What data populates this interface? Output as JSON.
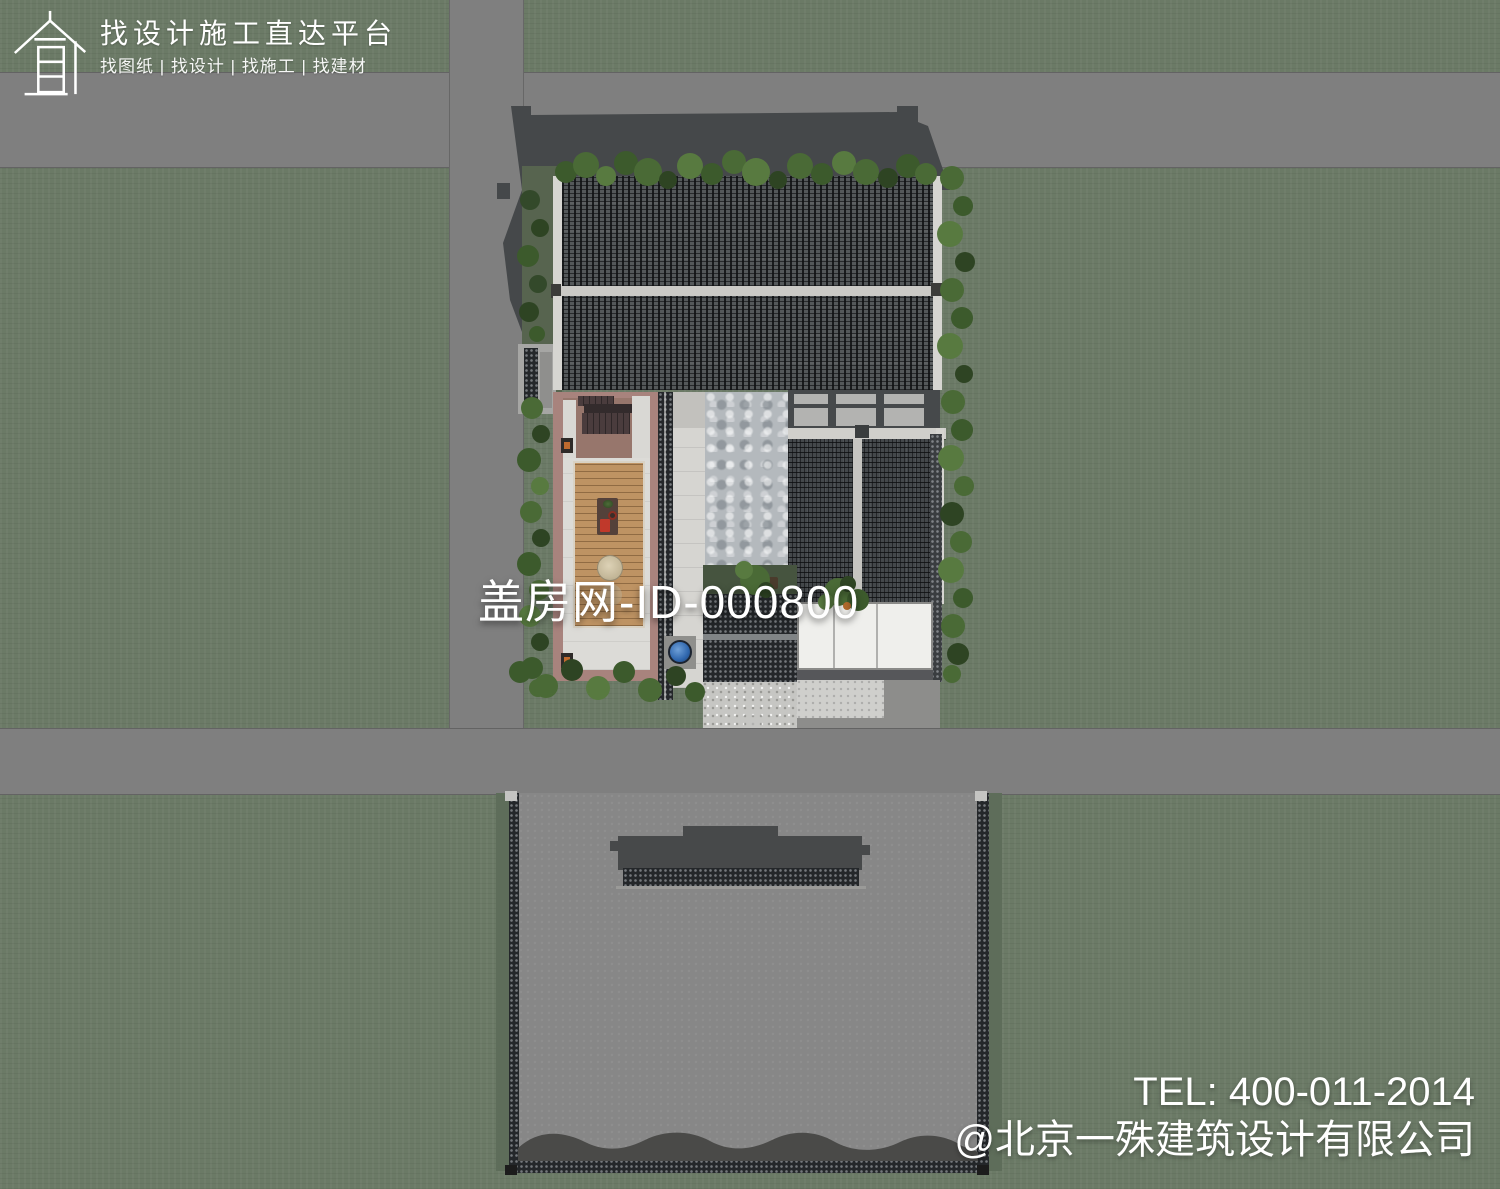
{
  "branding": {
    "platform_title": "找设计施工直达平台",
    "platform_tagline": "找图纸 | 找设计 | 找施工 | 找建材",
    "logo_icon": "house-outline-icon"
  },
  "watermark": {
    "text": "盖房网-ID-000800"
  },
  "contact": {
    "tel": "TEL: 400-011-2014",
    "company": "@北京一殊建筑设计有限公司"
  },
  "colors": {
    "grass": "#6b7a66",
    "road": "#7f7f7f",
    "roof_tile": "#54585a",
    "ridge_white": "#d6d5d1",
    "courtyard_border": "#a8837d",
    "wood_deck": "#be9363",
    "building_shadow": "#45484a",
    "white_roof": "#efefec",
    "basin_blue": "#2f66ad",
    "foliage": "#4a6a36",
    "paving": "#c6c6c3",
    "lower_plot_ground": "#878787"
  }
}
